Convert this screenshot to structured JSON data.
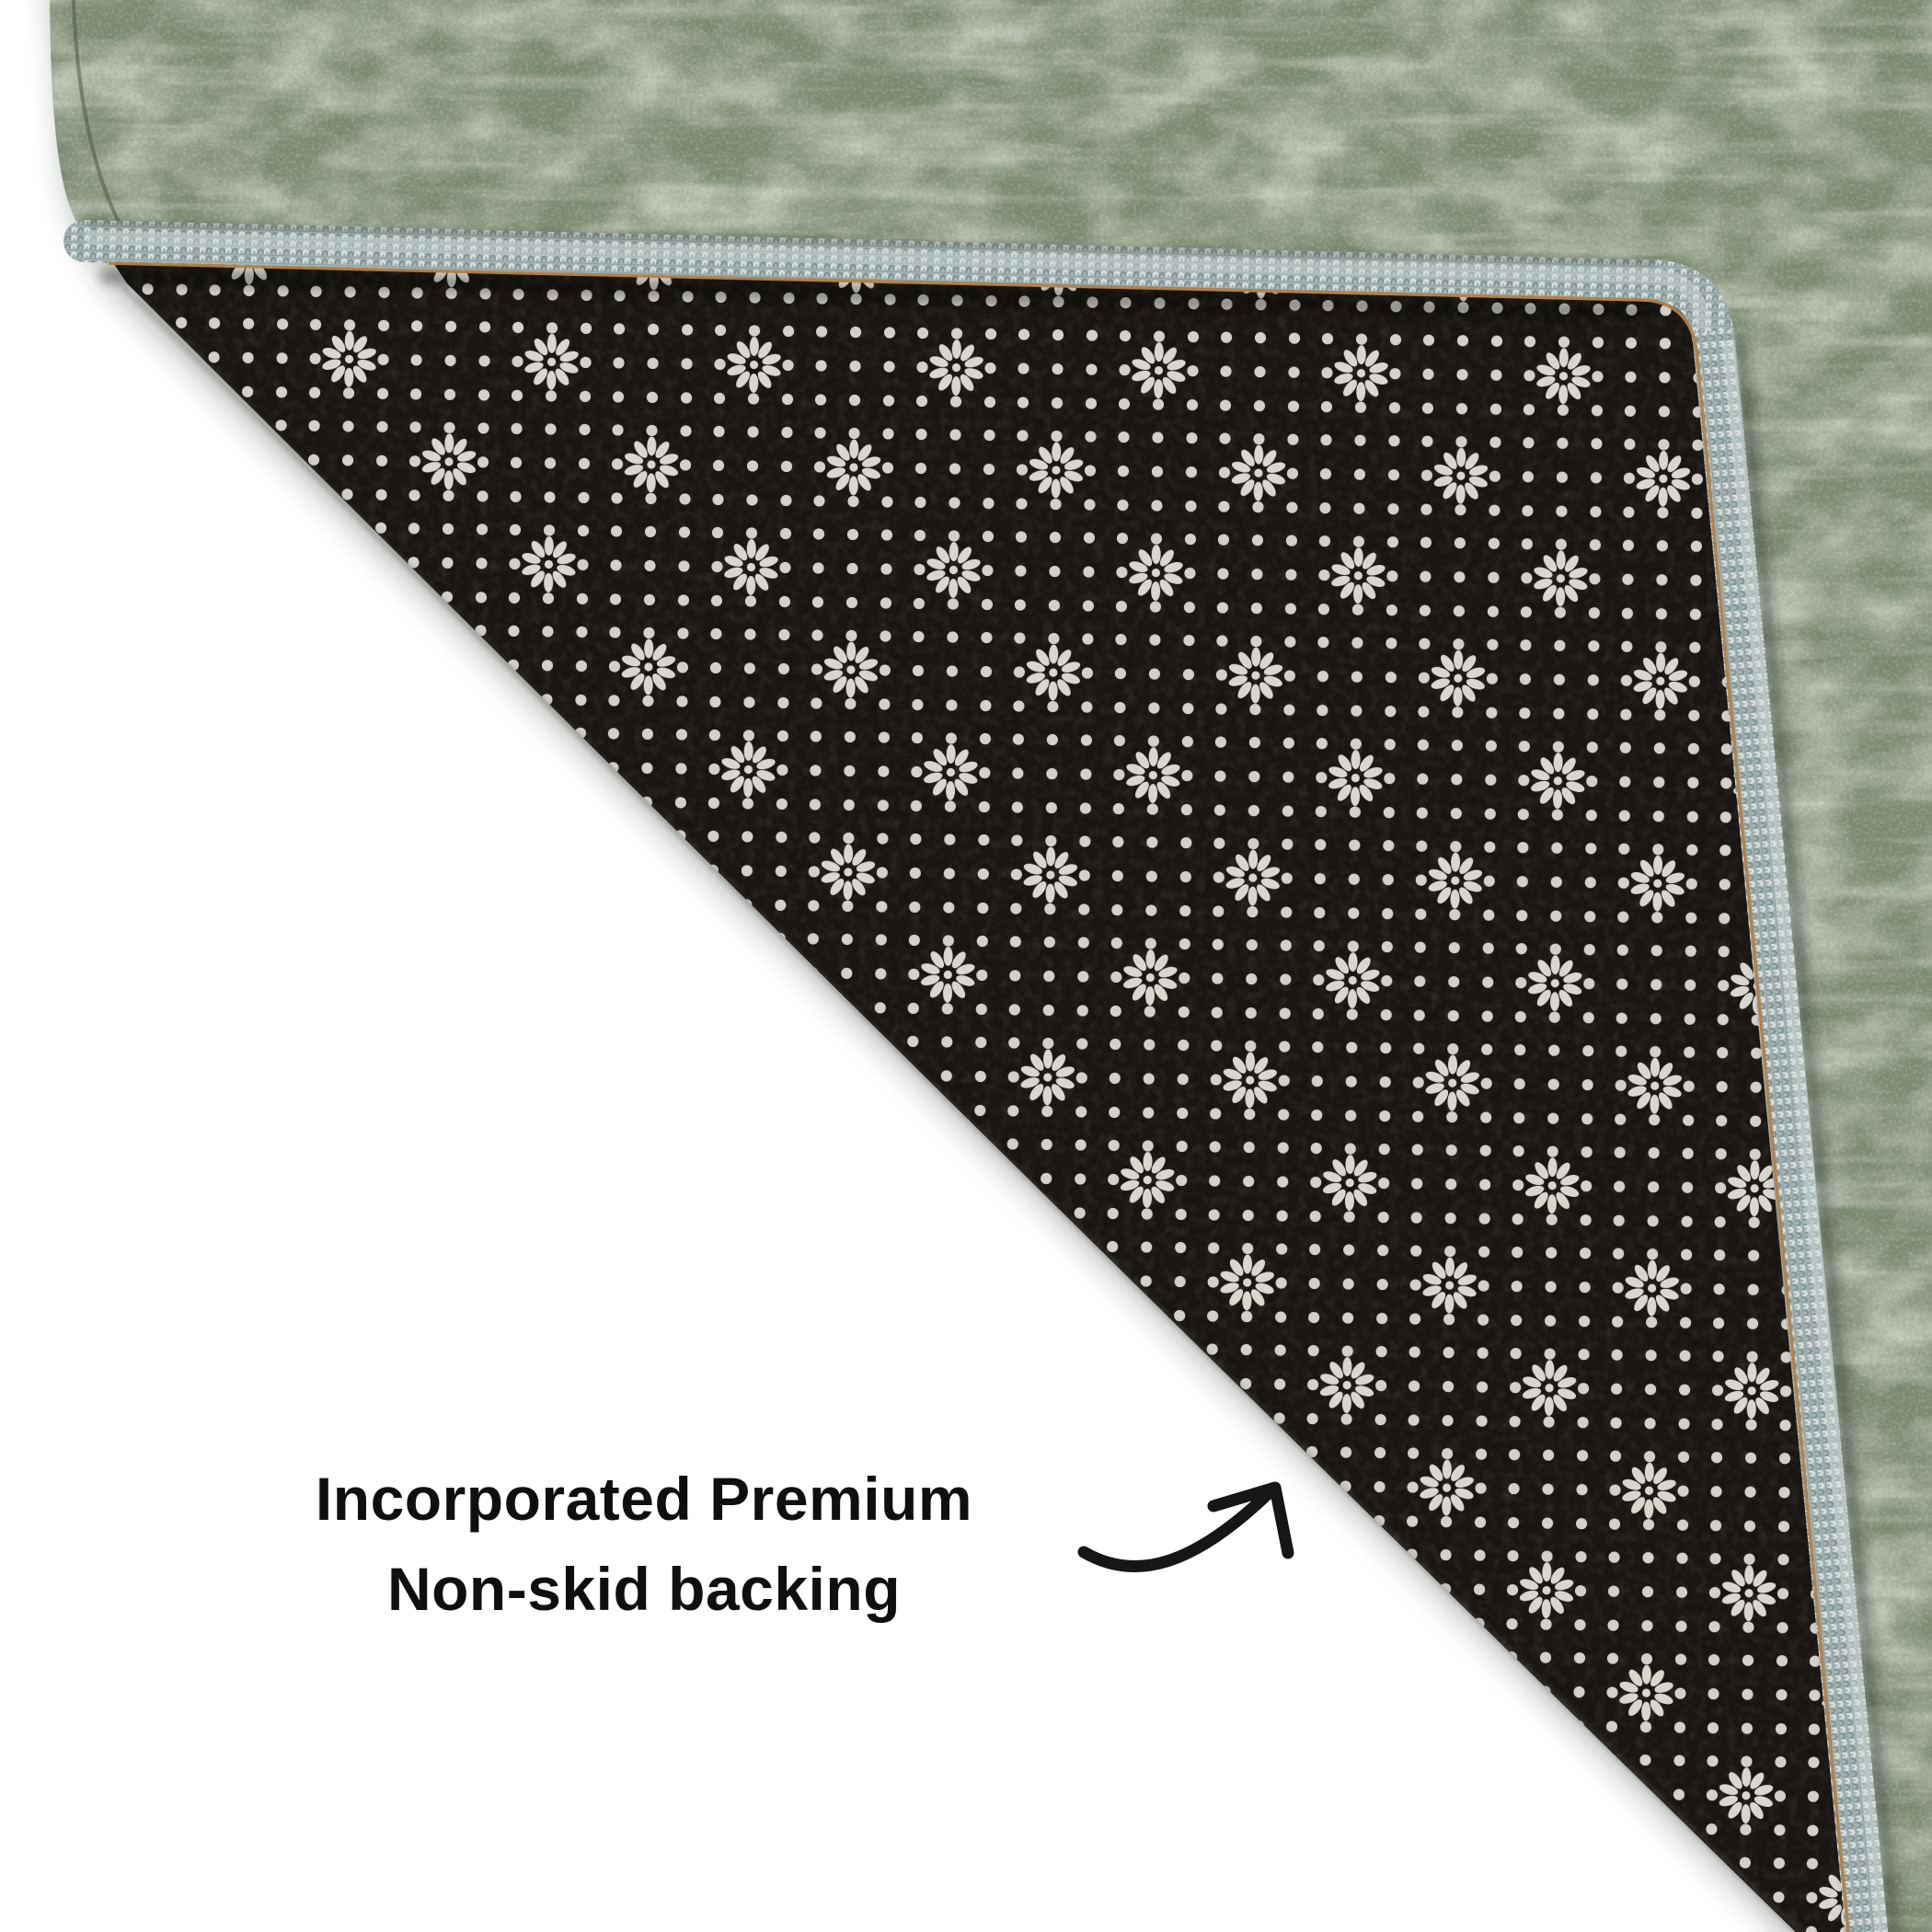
{
  "background_color": "#ffffff",
  "annotation": {
    "line1": "Incorporated Premium",
    "line2": "Non-skid backing",
    "color": "#0f0f0f"
  },
  "arrow": {
    "icon": "curved-arrow-icon",
    "color": "#161616"
  },
  "rug": {
    "face_color": "#7d8a72",
    "face_light_color": "#d5d9c6",
    "face_dark_color": "#46543f",
    "backing_color": "#181512",
    "backing_dot_color": "#d8d6cf",
    "binding_color": "#a9b6b5",
    "stitch_color": "#b0814b"
  }
}
